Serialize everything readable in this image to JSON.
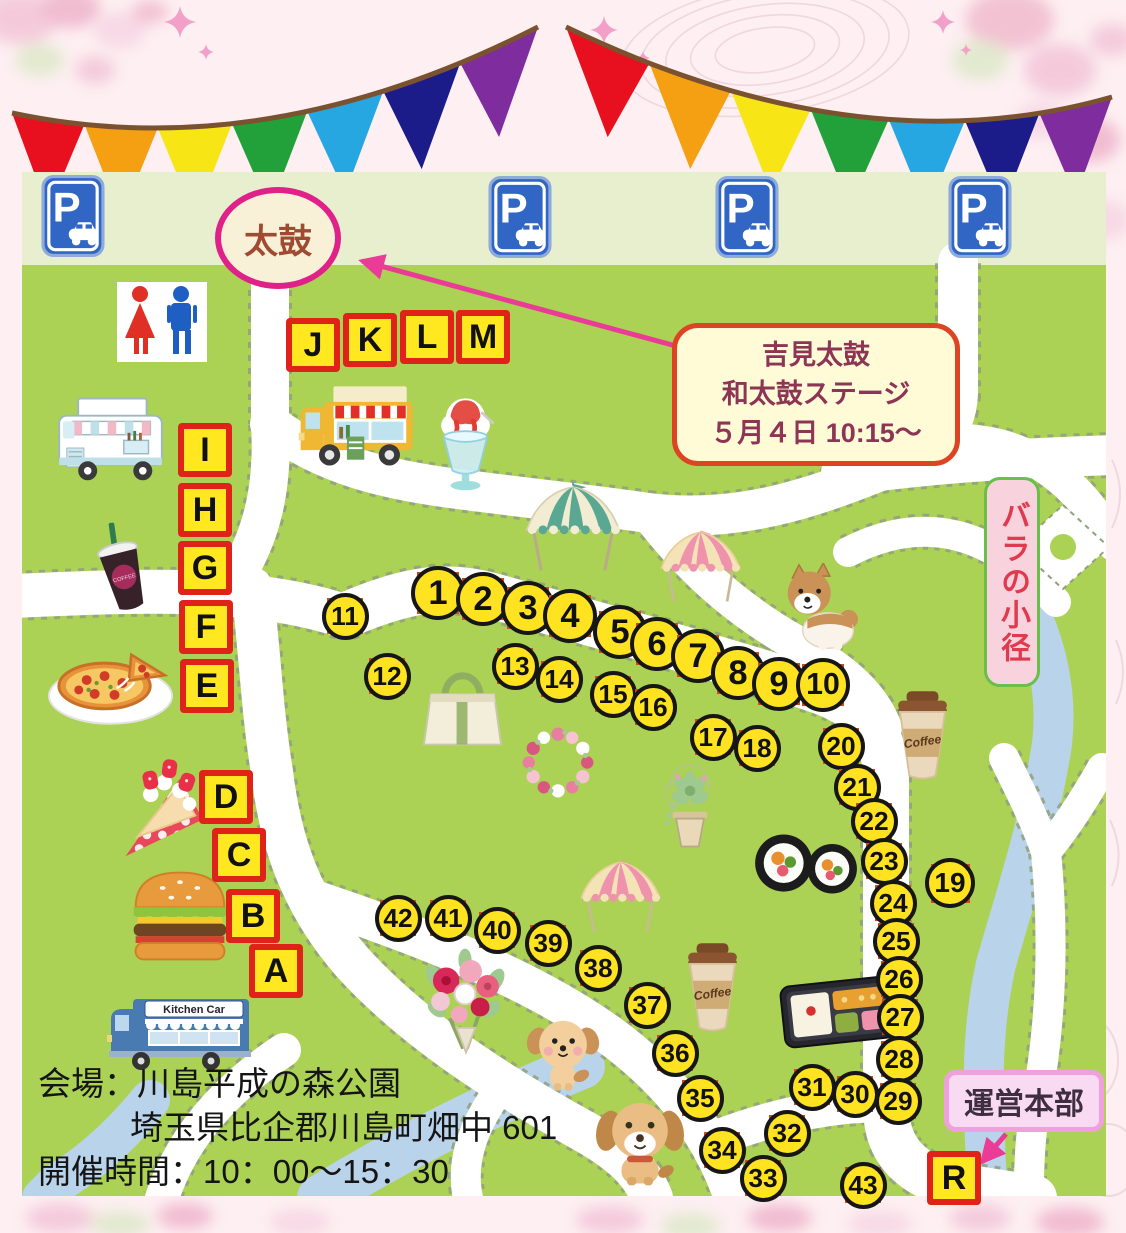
{
  "event": {
    "taiko_label": "太鼓",
    "stage_box": {
      "line1": "吉見太鼓",
      "line2": "和太鼓ステージ",
      "line3": "５月４日 10:15～"
    },
    "rose_path_label": "バラの小径",
    "hq_label": "運営本部"
  },
  "footer": {
    "line1": "会場：川島平成の森公園",
    "line2": "埼玉県比企郡川島町畑中 601",
    "line3": "開催時間：10：00～15：30"
  },
  "colors": {
    "map_green": "#abd155",
    "pale_band": "#e7efce",
    "road_white": "#ffffff",
    "road_edge": "#90a07e",
    "river_blue": "#b9d3ea",
    "marker_yellow": "#ffe320",
    "marker_square": "#d0481c",
    "letter_yellow": "#ffe81f",
    "letter_border": "#e02318",
    "arrow_pink": "#ea3c96",
    "oval_border": "#e0218a"
  },
  "bunting": {
    "rope_color": "#7a5230",
    "flag_depth": 92,
    "colors": [
      "#e8101e",
      "#f59f13",
      "#f7e516",
      "#22a13b",
      "#27a7e1",
      "#1c1b8a",
      "#7e2c9e"
    ],
    "strings": [
      {
        "x0": 12,
        "y0": 113,
        "cx": 264,
        "cy": 167,
        "x1": 538,
        "y1": 27
      },
      {
        "x0": 566,
        "y0": 27,
        "cx": 861,
        "cy": 169,
        "x1": 1112,
        "y1": 97
      }
    ]
  },
  "map": {
    "stalls": [
      {
        "n": "1",
        "x": 438,
        "y": 593,
        "d": 54
      },
      {
        "n": "2",
        "x": 483,
        "y": 599,
        "d": 54
      },
      {
        "n": "3",
        "x": 528,
        "y": 608,
        "d": 54
      },
      {
        "n": "4",
        "x": 570,
        "y": 616,
        "d": 54
      },
      {
        "n": "5",
        "x": 620,
        "y": 632,
        "d": 54
      },
      {
        "n": "6",
        "x": 657,
        "y": 644,
        "d": 54
      },
      {
        "n": "7",
        "x": 698,
        "y": 656,
        "d": 54
      },
      {
        "n": "8",
        "x": 738,
        "y": 673,
        "d": 54
      },
      {
        "n": "9",
        "x": 779,
        "y": 684,
        "d": 54
      },
      {
        "n": "10",
        "x": 823,
        "y": 685,
        "d": 54
      },
      {
        "n": "11",
        "x": 345,
        "y": 616,
        "d": 47
      },
      {
        "n": "12",
        "x": 387,
        "y": 676,
        "d": 47
      },
      {
        "n": "13",
        "x": 515,
        "y": 666,
        "d": 47
      },
      {
        "n": "14",
        "x": 559,
        "y": 679,
        "d": 47
      },
      {
        "n": "15",
        "x": 613,
        "y": 694,
        "d": 47
      },
      {
        "n": "16",
        "x": 653,
        "y": 707,
        "d": 47
      },
      {
        "n": "17",
        "x": 713,
        "y": 737,
        "d": 47
      },
      {
        "n": "18",
        "x": 757,
        "y": 748,
        "d": 47
      },
      {
        "n": "19",
        "x": 950,
        "y": 883,
        "d": 50
      },
      {
        "n": "20",
        "x": 841,
        "y": 746,
        "d": 47
      },
      {
        "n": "21",
        "x": 857,
        "y": 787,
        "d": 47
      },
      {
        "n": "22",
        "x": 874,
        "y": 821,
        "d": 47
      },
      {
        "n": "23",
        "x": 884,
        "y": 861,
        "d": 47
      },
      {
        "n": "24",
        "x": 893,
        "y": 903,
        "d": 47
      },
      {
        "n": "25",
        "x": 896,
        "y": 941,
        "d": 47
      },
      {
        "n": "26",
        "x": 899,
        "y": 979,
        "d": 47
      },
      {
        "n": "27",
        "x": 900,
        "y": 1017,
        "d": 47
      },
      {
        "n": "28",
        "x": 899,
        "y": 1059,
        "d": 47
      },
      {
        "n": "29",
        "x": 898,
        "y": 1101,
        "d": 47
      },
      {
        "n": "30",
        "x": 855,
        "y": 1094,
        "d": 47
      },
      {
        "n": "31",
        "x": 812,
        "y": 1087,
        "d": 47
      },
      {
        "n": "32",
        "x": 787,
        "y": 1133,
        "d": 47
      },
      {
        "n": "33",
        "x": 763,
        "y": 1178,
        "d": 47
      },
      {
        "n": "34",
        "x": 722,
        "y": 1150,
        "d": 47
      },
      {
        "n": "35",
        "x": 700,
        "y": 1098,
        "d": 47
      },
      {
        "n": "36",
        "x": 675,
        "y": 1053,
        "d": 47
      },
      {
        "n": "37",
        "x": 647,
        "y": 1005,
        "d": 47
      },
      {
        "n": "38",
        "x": 598,
        "y": 968,
        "d": 47
      },
      {
        "n": "39",
        "x": 548,
        "y": 943,
        "d": 47
      },
      {
        "n": "40",
        "x": 497,
        "y": 930,
        "d": 47
      },
      {
        "n": "41",
        "x": 448,
        "y": 918,
        "d": 47
      },
      {
        "n": "42",
        "x": 398,
        "y": 918,
        "d": 47
      },
      {
        "n": "43",
        "x": 863,
        "y": 1185,
        "d": 47
      }
    ],
    "letters": [
      {
        "ch": "J",
        "x": 313,
        "y": 345
      },
      {
        "ch": "K",
        "x": 370,
        "y": 340
      },
      {
        "ch": "L",
        "x": 427,
        "y": 337
      },
      {
        "ch": "M",
        "x": 483,
        "y": 337
      },
      {
        "ch": "I",
        "x": 205,
        "y": 450
      },
      {
        "ch": "H",
        "x": 205,
        "y": 510
      },
      {
        "ch": "G",
        "x": 205,
        "y": 568
      },
      {
        "ch": "F",
        "x": 206,
        "y": 627
      },
      {
        "ch": "E",
        "x": 207,
        "y": 686
      },
      {
        "ch": "D",
        "x": 226,
        "y": 797
      },
      {
        "ch": "C",
        "x": 239,
        "y": 855
      },
      {
        "ch": "B",
        "x": 253,
        "y": 916
      },
      {
        "ch": "A",
        "x": 276,
        "y": 971
      },
      {
        "ch": "R",
        "x": 954,
        "y": 1178
      }
    ],
    "illustrations": [
      {
        "name": "parking-sign-1",
        "sym": "parking",
        "x": 73,
        "y": 216,
        "w": 64,
        "h": 82
      },
      {
        "name": "parking-sign-2",
        "sym": "parking",
        "x": 520,
        "y": 217,
        "w": 64,
        "h": 82
      },
      {
        "name": "parking-sign-3",
        "sym": "parking",
        "x": 747,
        "y": 217,
        "w": 64,
        "h": 82
      },
      {
        "name": "parking-sign-4",
        "sym": "parking",
        "x": 980,
        "y": 217,
        "w": 64,
        "h": 82
      },
      {
        "name": "restroom-icon",
        "sym": "restroom",
        "x": 162,
        "y": 322,
        "w": 90,
        "h": 80
      },
      {
        "name": "food-truck-yellow",
        "sym": "truck-yellow",
        "x": 358,
        "y": 425,
        "w": 135,
        "h": 100
      },
      {
        "name": "shaved-ice",
        "sym": "shaved-ice",
        "x": 465,
        "y": 440,
        "w": 75,
        "h": 105
      },
      {
        "name": "food-truck-white",
        "sym": "truck-white",
        "x": 110,
        "y": 438,
        "w": 135,
        "h": 95
      },
      {
        "name": "iced-coffee",
        "sym": "coffee-dark",
        "x": 122,
        "y": 570,
        "w": 85,
        "h": 115
      },
      {
        "name": "pizza",
        "sym": "pizza",
        "x": 112,
        "y": 684,
        "w": 135,
        "h": 92
      },
      {
        "name": "crepe",
        "sym": "crepe",
        "x": 158,
        "y": 802,
        "w": 105,
        "h": 120
      },
      {
        "name": "hamburger",
        "sym": "burger",
        "x": 180,
        "y": 915,
        "w": 120,
        "h": 108
      },
      {
        "name": "kitchen-car-blue",
        "sym": "truck-blue",
        "x": 180,
        "y": 1025,
        "w": 150,
        "h": 100
      },
      {
        "name": "tent-green",
        "sym": "tent-green",
        "x": 573,
        "y": 528,
        "w": 112,
        "h": 92
      },
      {
        "name": "tent-pink-1",
        "sym": "tent-pink",
        "x": 700,
        "y": 566,
        "w": 95,
        "h": 78
      },
      {
        "name": "tent-pink-2",
        "sym": "tent-pink",
        "x": 620,
        "y": 896,
        "w": 95,
        "h": 78
      },
      {
        "name": "dog-shiba",
        "sym": "dog-shiba",
        "x": 820,
        "y": 608,
        "w": 95,
        "h": 90
      },
      {
        "name": "tote-bag",
        "sym": "tote",
        "x": 462,
        "y": 703,
        "w": 95,
        "h": 98
      },
      {
        "name": "flower-wreath",
        "sym": "wreath",
        "x": 558,
        "y": 762,
        "w": 88,
        "h": 85
      },
      {
        "name": "flower-pot",
        "sym": "flowerpot",
        "x": 690,
        "y": 803,
        "w": 80,
        "h": 100
      },
      {
        "name": "sushi-roll",
        "sym": "sushi",
        "x": 806,
        "y": 864,
        "w": 115,
        "h": 78
      },
      {
        "name": "coffee-cup-1",
        "sym": "coffee-togo",
        "x": 922,
        "y": 732,
        "w": 85,
        "h": 105
      },
      {
        "name": "coffee-cup-2",
        "sym": "coffee-togo",
        "x": 712,
        "y": 984,
        "w": 85,
        "h": 105
      },
      {
        "name": "bento-box",
        "sym": "bento",
        "x": 838,
        "y": 1012,
        "w": 130,
        "h": 88
      },
      {
        "name": "flower-bouquet",
        "sym": "bouquet",
        "x": 465,
        "y": 1000,
        "w": 110,
        "h": 115
      },
      {
        "name": "dog-small",
        "sym": "dog-small",
        "x": 563,
        "y": 1052,
        "w": 90,
        "h": 88
      },
      {
        "name": "dog-puppy",
        "sym": "dog-puppy",
        "x": 640,
        "y": 1140,
        "w": 100,
        "h": 100
      }
    ]
  }
}
